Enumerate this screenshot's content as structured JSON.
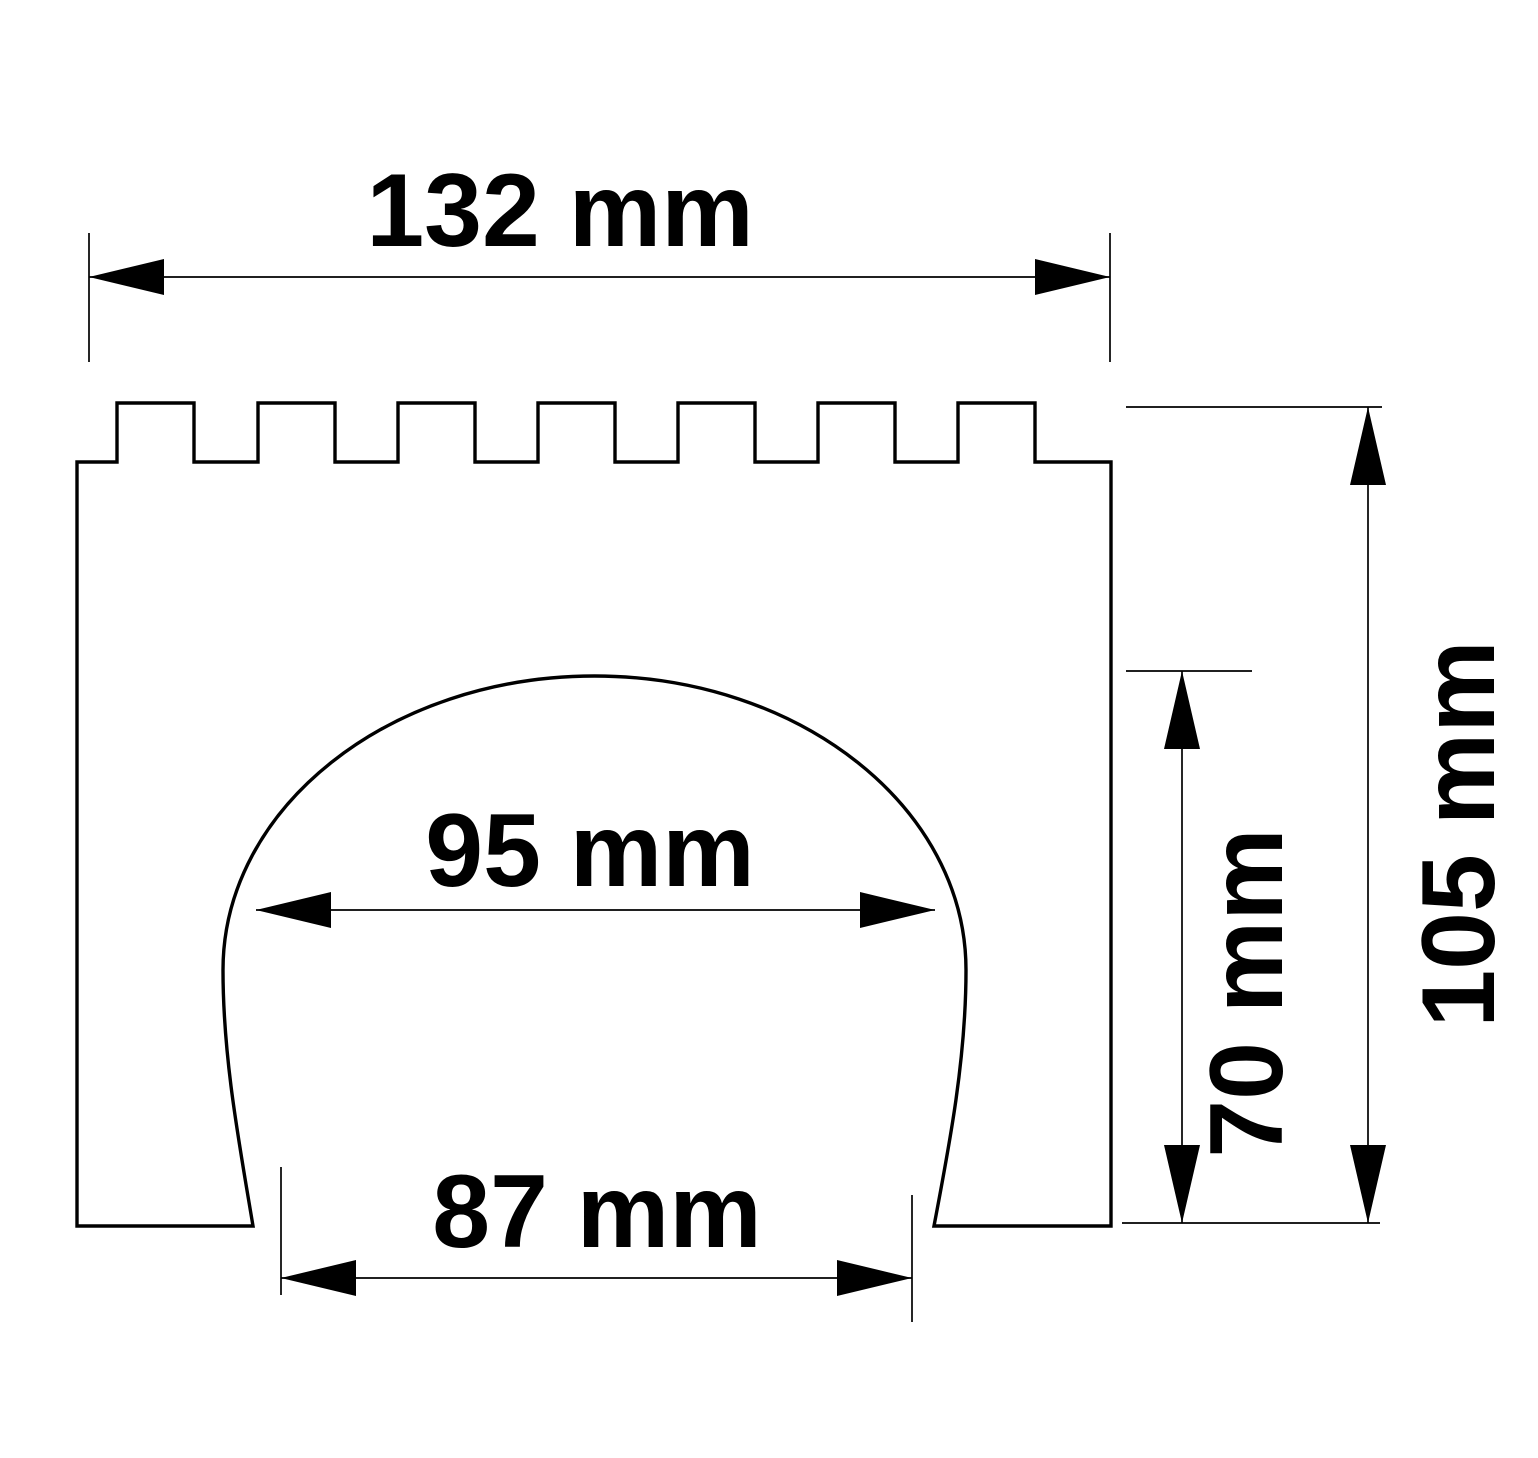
{
  "title": "Dimensioned technical drawing of a crenellated arch block",
  "units": "mm",
  "style": {
    "line_color": "#000000",
    "background_color": "#ffffff",
    "text_color": "#000000"
  },
  "shape": {
    "teeth_count": 7,
    "description": "castle-wall profile with crenellated top and arched opening"
  },
  "dimensions": {
    "total_width": {
      "label": "132 mm",
      "value": 132,
      "unit": "mm",
      "orientation": "horizontal"
    },
    "arch_width": {
      "label": "95 mm",
      "value": 95,
      "unit": "mm",
      "orientation": "horizontal"
    },
    "base_opening_width": {
      "label": "87 mm",
      "value": 87,
      "unit": "mm",
      "orientation": "horizontal"
    },
    "arch_height": {
      "label": "70 mm",
      "value": 70,
      "unit": "mm",
      "orientation": "vertical"
    },
    "total_height": {
      "label": "105 mm",
      "value": 105,
      "unit": "mm",
      "orientation": "vertical"
    }
  }
}
